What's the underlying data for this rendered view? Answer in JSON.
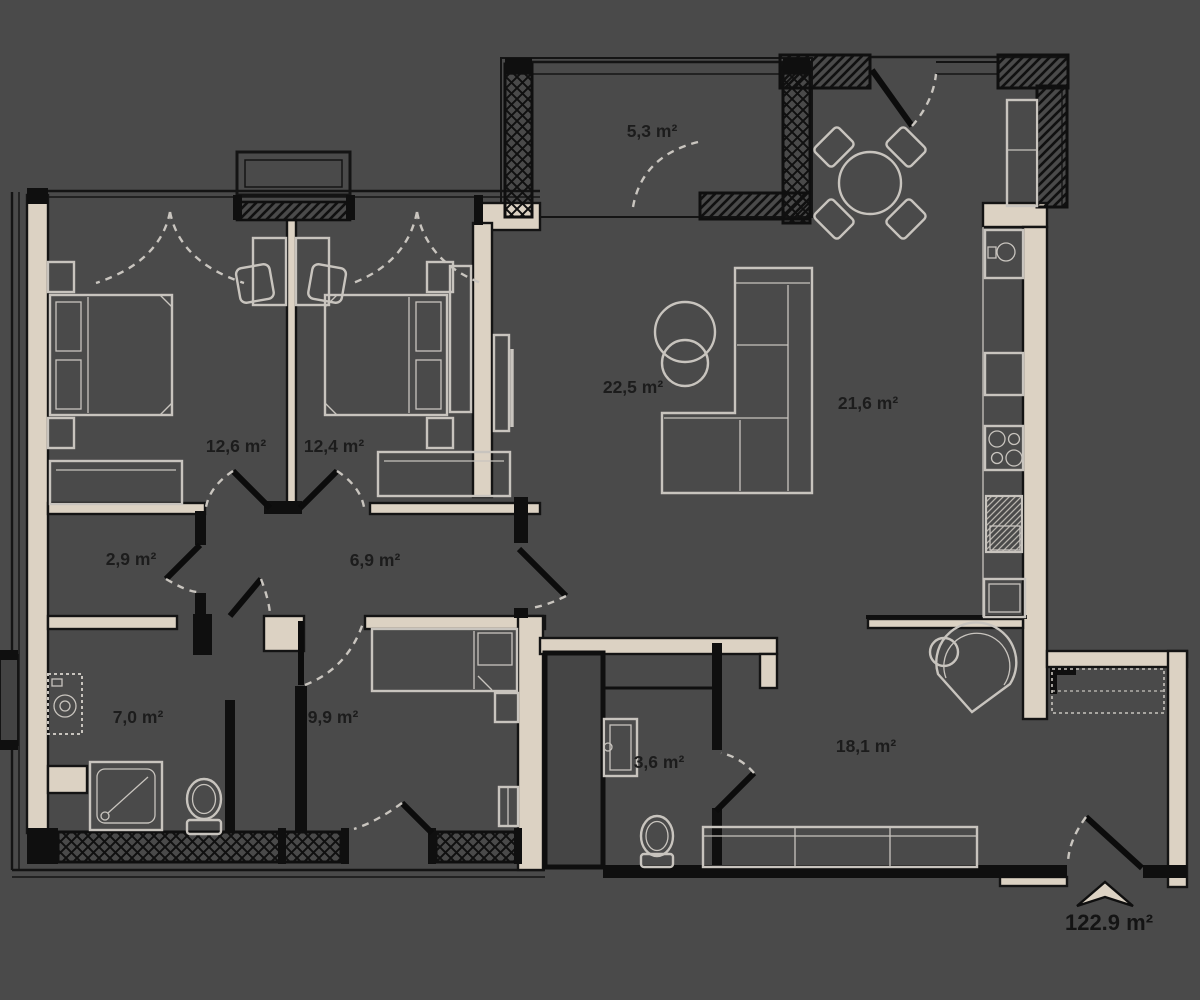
{
  "plan": {
    "type": "apartment-floor-plan",
    "units": "m²",
    "total": {
      "label": "122.9 m²"
    },
    "colors": {
      "background": "#4a4a4a",
      "wall_fill": "#dcd2c3",
      "wall_stroke": "#0f0f0f",
      "furniture_stroke": "#c8c4be",
      "label_color": "#1c1c1c"
    },
    "rooms": [
      {
        "id": "balcony",
        "area": "5,3 m²"
      },
      {
        "id": "living-room",
        "area": "22,5 m²"
      },
      {
        "id": "kitchen",
        "area": "21,6 m²"
      },
      {
        "id": "bedroom-1",
        "area": "12,6 m²"
      },
      {
        "id": "bedroom-2",
        "area": "12,4 m²"
      },
      {
        "id": "closet",
        "area": "2,9 m²"
      },
      {
        "id": "hallway",
        "area": "6,9 m²"
      },
      {
        "id": "bathroom",
        "area": "7,0 m²"
      },
      {
        "id": "kids-room",
        "area": "9,9 m²"
      },
      {
        "id": "wc",
        "area": "3,6 m²"
      },
      {
        "id": "entrance-hall",
        "area": "18,1 m²"
      }
    ],
    "furniture_icons": [
      "double-bed-icon",
      "nightstand-icon",
      "wardrobe-icon",
      "desk-icon",
      "chair-icon",
      "corner-sofa-icon",
      "coffee-table-icon",
      "tv-icon",
      "dining-table-icon",
      "kitchen-counter-icon",
      "sink-icon",
      "hob-icon",
      "fridge-icon",
      "washing-machine-icon",
      "shower-icon",
      "toilet-icon",
      "washbasin-icon",
      "single-bed-icon",
      "armchair-icon",
      "closet-icon",
      "entrance-arrow-icon"
    ]
  }
}
